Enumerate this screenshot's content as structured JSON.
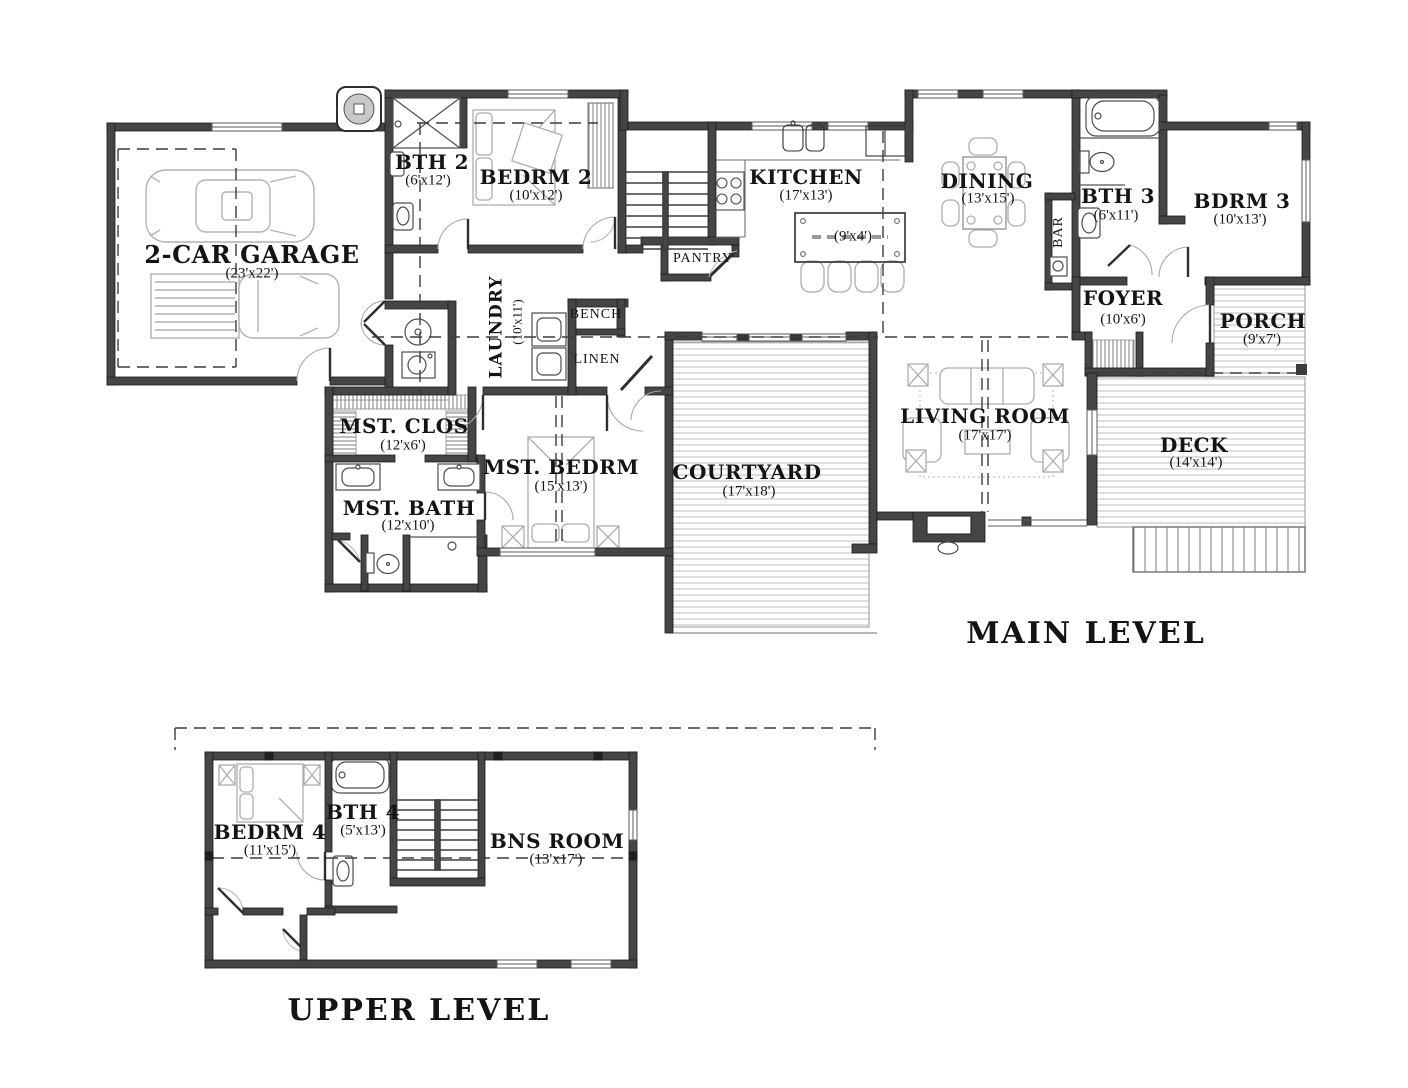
{
  "plan": {
    "main": {
      "title": "MAIN LEVEL",
      "rooms": {
        "garage": {
          "name": "2-CAR GARAGE",
          "dims": "(23'x22')"
        },
        "bth2": {
          "name": "BTH 2",
          "dims": "(6'x12')"
        },
        "bedrm2": {
          "name": "BEDRM 2",
          "dims": "(10'x12')"
        },
        "kitchen": {
          "name": "KITCHEN",
          "dims": "(17'x13')"
        },
        "island": {
          "name": "ISLAND",
          "dims": "(9'x4')"
        },
        "pantry": {
          "name": "PANTRY",
          "dims": ""
        },
        "dining": {
          "name": "DINING",
          "dims": "(13'x15')"
        },
        "bar": {
          "name": "BAR",
          "dims": ""
        },
        "bth3": {
          "name": "BTH 3",
          "dims": "(6'x11')"
        },
        "bdrm3": {
          "name": "BDRM 3",
          "dims": "(10'x13')"
        },
        "foyer": {
          "name": "FOYER",
          "dims": "(10'x6')"
        },
        "porch": {
          "name": "PORCH",
          "dims": "(9'x7')"
        },
        "deck": {
          "name": "DECK",
          "dims": "(14'x14')"
        },
        "living": {
          "name": "LIVING ROOM",
          "dims": "(17'x17')"
        },
        "courtyard": {
          "name": "COURTYARD",
          "dims": "(17'x18')"
        },
        "mst_bedrm": {
          "name": "MST. BEDRM",
          "dims": "(15'x13')"
        },
        "mst_clos": {
          "name": "MST. CLOS",
          "dims": "(12'x6')"
        },
        "mst_bath": {
          "name": "MST. BATH",
          "dims": "(12'x10')"
        },
        "laundry": {
          "name": "LAUNDRY",
          "dims": "(10'x11')"
        },
        "bench": {
          "name": "BENCH",
          "dims": ""
        },
        "linen": {
          "name": "LINEN",
          "dims": ""
        }
      }
    },
    "upper": {
      "title": "UPPER LEVEL",
      "rooms": {
        "bedrm4": {
          "name": "BEDRM 4",
          "dims": "(11'x15')"
        },
        "bth4": {
          "name": "BTH 4",
          "dims": "(5'x13')"
        },
        "bns": {
          "name": "BNS ROOM",
          "dims": "(13'x17')"
        }
      }
    }
  }
}
